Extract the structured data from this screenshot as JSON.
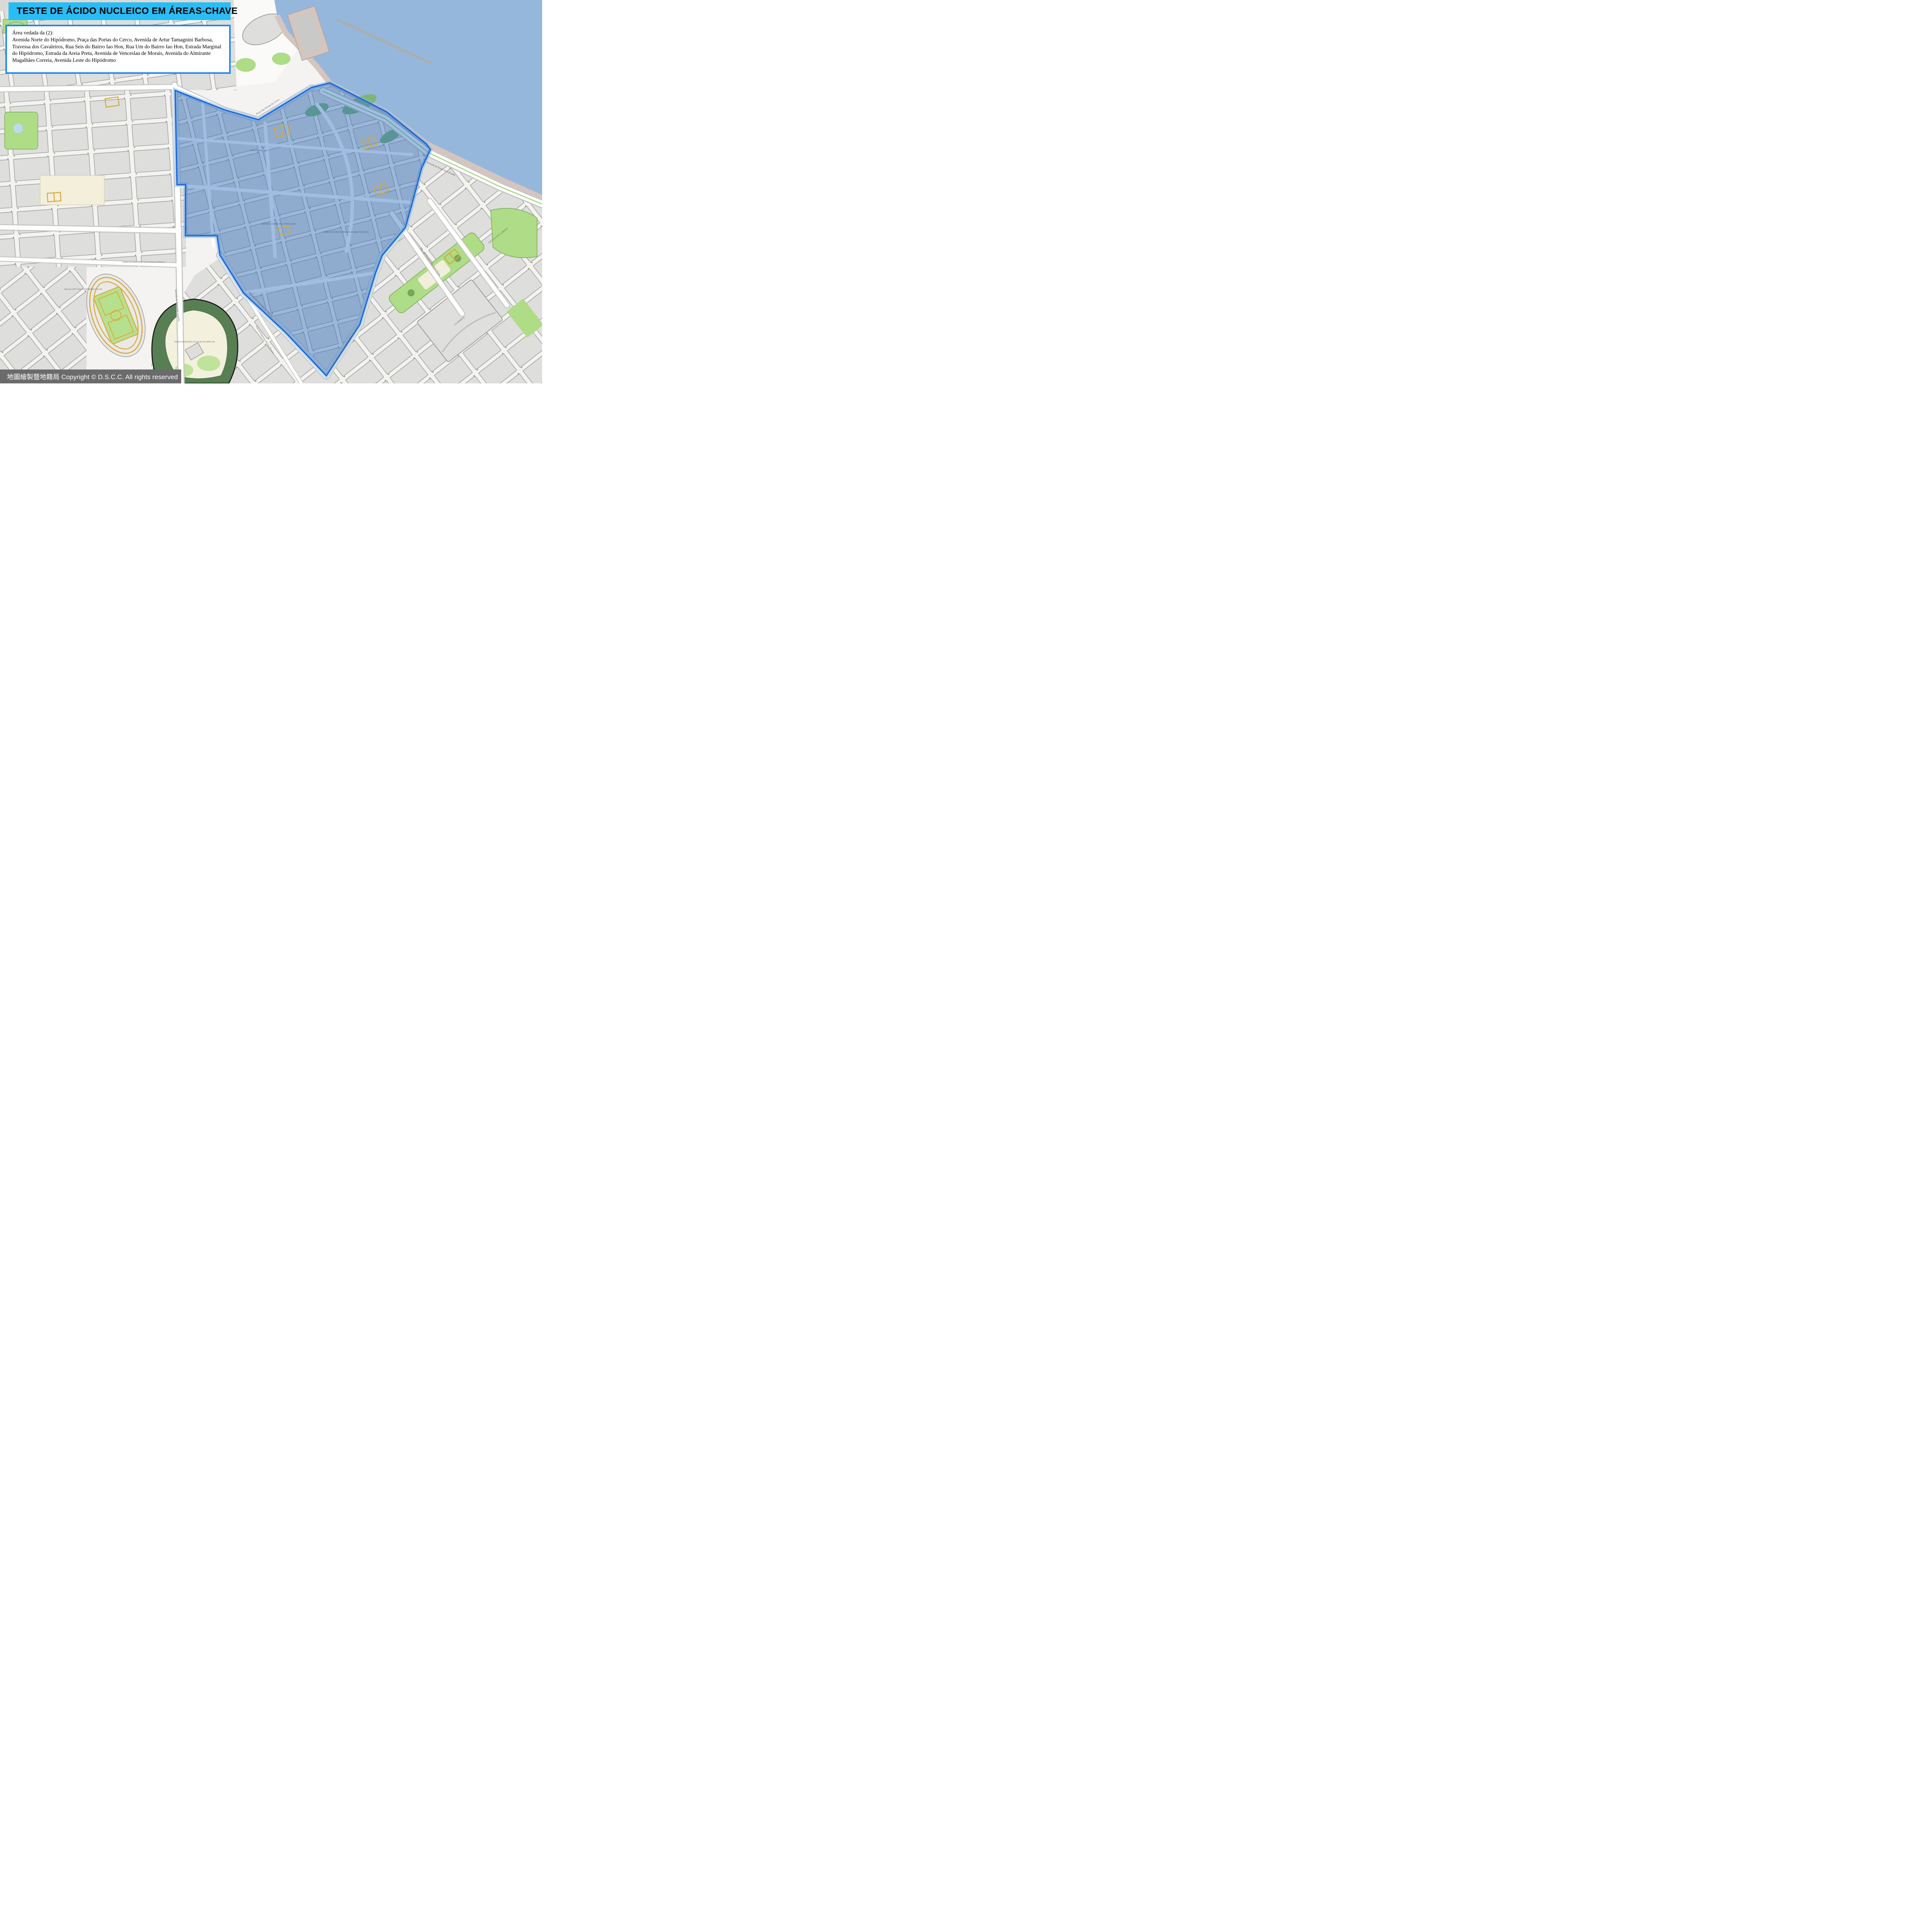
{
  "title_banner": {
    "text": "TESTE DE ÁCIDO NUCLEICO EM ÁREAS-CHAVE",
    "bg_color": "#29BDF6",
    "text_color": "#000000"
  },
  "info_box": {
    "heading": "Área vedada da (2):",
    "body": "Avenida Norte do Hipódromo, Praça das Portas do Cerco, Avenida de Artur Tamagnini Barbosa, Travessa dos Cavaleiros, Rua Seis do Bairro Iao Hon, Rua Um do Bairro Iao Hon, Estrada Marginal do Hipódromo, Estrada da Areia Preta, Avenida de Venceslau de Morais, Avenida do Almirante Magalhães Correia, Avenida Leste do Hipódromo",
    "border_color": "#1E88F2",
    "bg_color": "#FFFFFF"
  },
  "copyright_bar": {
    "text": "地圖繪製暨地籍局 Copyright © D.S.C.C. All rights reserved",
    "bg_color": "#6B6B6B",
    "text_color": "#FFFFFF"
  },
  "restricted_zone": {
    "name": "Área vedada (2)",
    "fill": "#2F6FBF",
    "fill_opacity": "0.45",
    "stroke": "#1565D8",
    "halo": "#86B6E6"
  },
  "map": {
    "colors": {
      "water": "#95B7DC",
      "land": "#F4F3F1",
      "building": "#DEDEDC",
      "building_outline": "#9B9B99",
      "park": "#AFDC86",
      "forest": "#587F54",
      "hill_ground": "#F4F0DE",
      "seawall": "#D5C5BF",
      "track": "#D9A93C",
      "sports_field": "#B7E08E",
      "road": "#FFFFFF",
      "road_casing": "#C6C6C4",
      "cream_campus": "#F4EFDA"
    },
    "labels": [
      {
        "text": "Praça das Portas do Cerco"
      },
      {
        "text": "Avenida da Ponte da Amizade"
      },
      {
        "text": "Avenida do Almirante Lacerda"
      },
      {
        "text": "Avenida de Venceslau de Morais"
      },
      {
        "text": "Avenida do Almirante Magalhães Correia"
      },
      {
        "text": "Estrada Marginal da Areia Preta"
      },
      {
        "text": "Rua de Francisco Xavier Pereira"
      },
      {
        "text": "MERCADO MUNICIPAL DO BAIRRO IAO HON"
      },
      {
        "text": "CENTRO COMERCIAL VONG KAM"
      },
      {
        "text": "SUN STAR PLAZA"
      },
      {
        "text": "MACAU YAT YUEN CANÍDROMO CO.LTD."
      },
      {
        "text": "CORPO DE POLÍCIA DE SEGURANÇA PÚBLICA"
      },
      {
        "text": "PARQUE MUNICIPAL DA COLINA DE MONG HÁ"
      },
      {
        "text": "LA MARINA"
      },
      {
        "text": "EDF. POLYTEC GARDEN"
      }
    ]
  }
}
